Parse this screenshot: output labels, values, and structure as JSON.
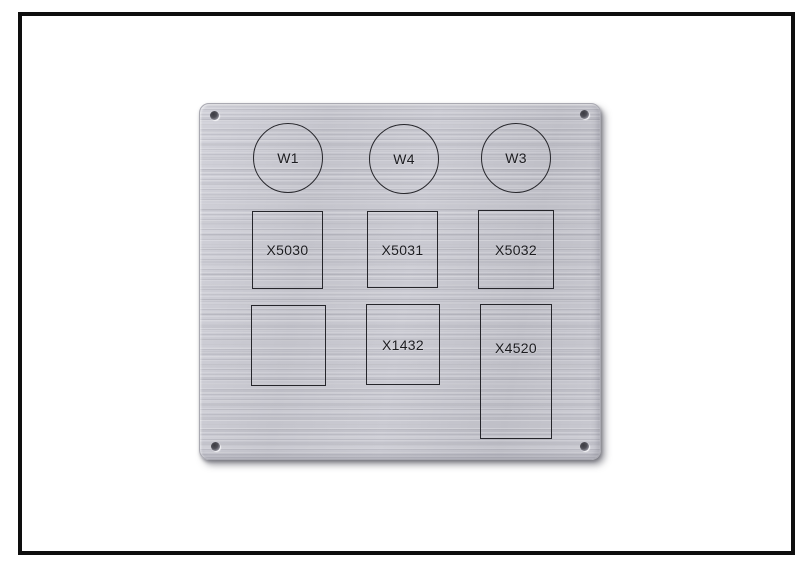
{
  "panel": {
    "circles": [
      {
        "label": "W1"
      },
      {
        "label": "W4"
      },
      {
        "label": "W3"
      }
    ],
    "cutouts": [
      {
        "label": "X5030"
      },
      {
        "label": "X5031"
      },
      {
        "label": "X5032"
      },
      {
        "label": ""
      },
      {
        "label": "X1432"
      },
      {
        "label": "X4520"
      }
    ]
  },
  "colors": {
    "background": "#ffffff",
    "frame_border": "#0e0e0e",
    "metal_base": "#c6c6ce",
    "metal_highlight": "#d1d1d9",
    "metal_shadow": "#bfbfc7",
    "engraving_stroke": "#26262b",
    "label_text": "#1c1c20"
  }
}
